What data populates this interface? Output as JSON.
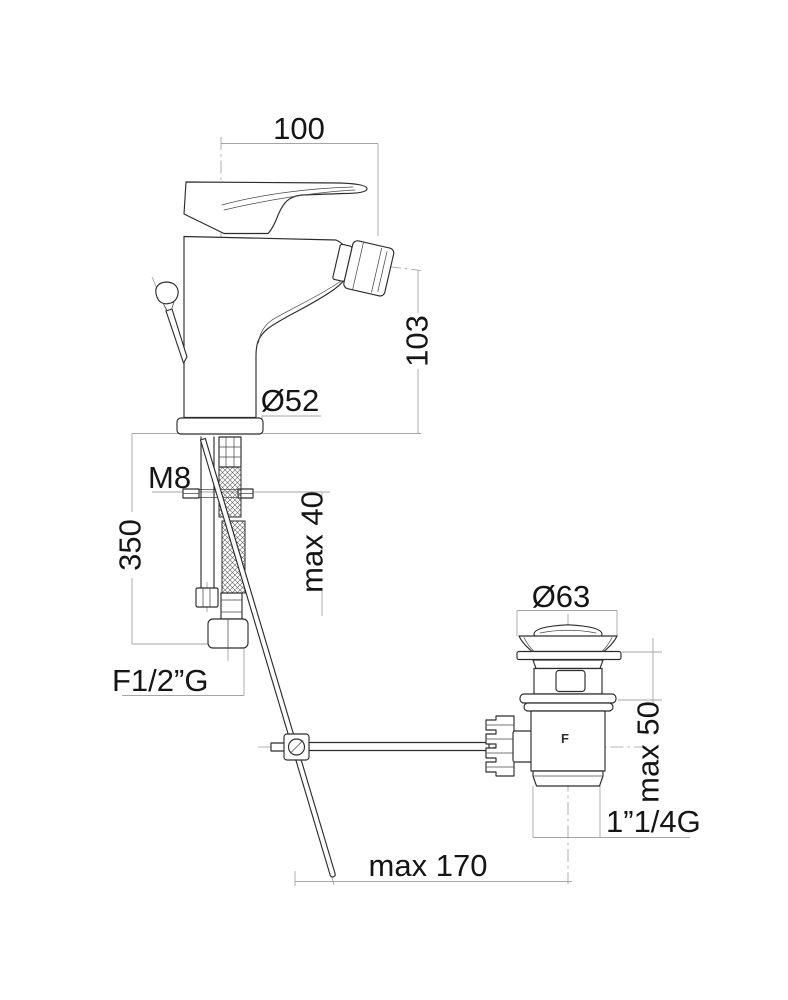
{
  "page": {
    "background": "#ffffff"
  },
  "drawing": {
    "type": "technical-dimension-drawing",
    "subject": "single-lever bidet mixer with pop-up waste",
    "line_color": "#2d2d2d",
    "dim_color": "#a6a6a6",
    "labels": {
      "spout_reach": "100",
      "spout_height": "103",
      "body_diameter": "Ø52",
      "fixing_stud": "M8",
      "hose_length": "350",
      "deck_thickness_max": "max 40",
      "hose_connection": "F1/2”G",
      "waste_flange_diameter": "Ø63",
      "waste_deck_max": "max 50",
      "waste_outlet_thread": "1”1/4G",
      "rod_projection_max": "max 170",
      "body_mark": "F"
    }
  }
}
